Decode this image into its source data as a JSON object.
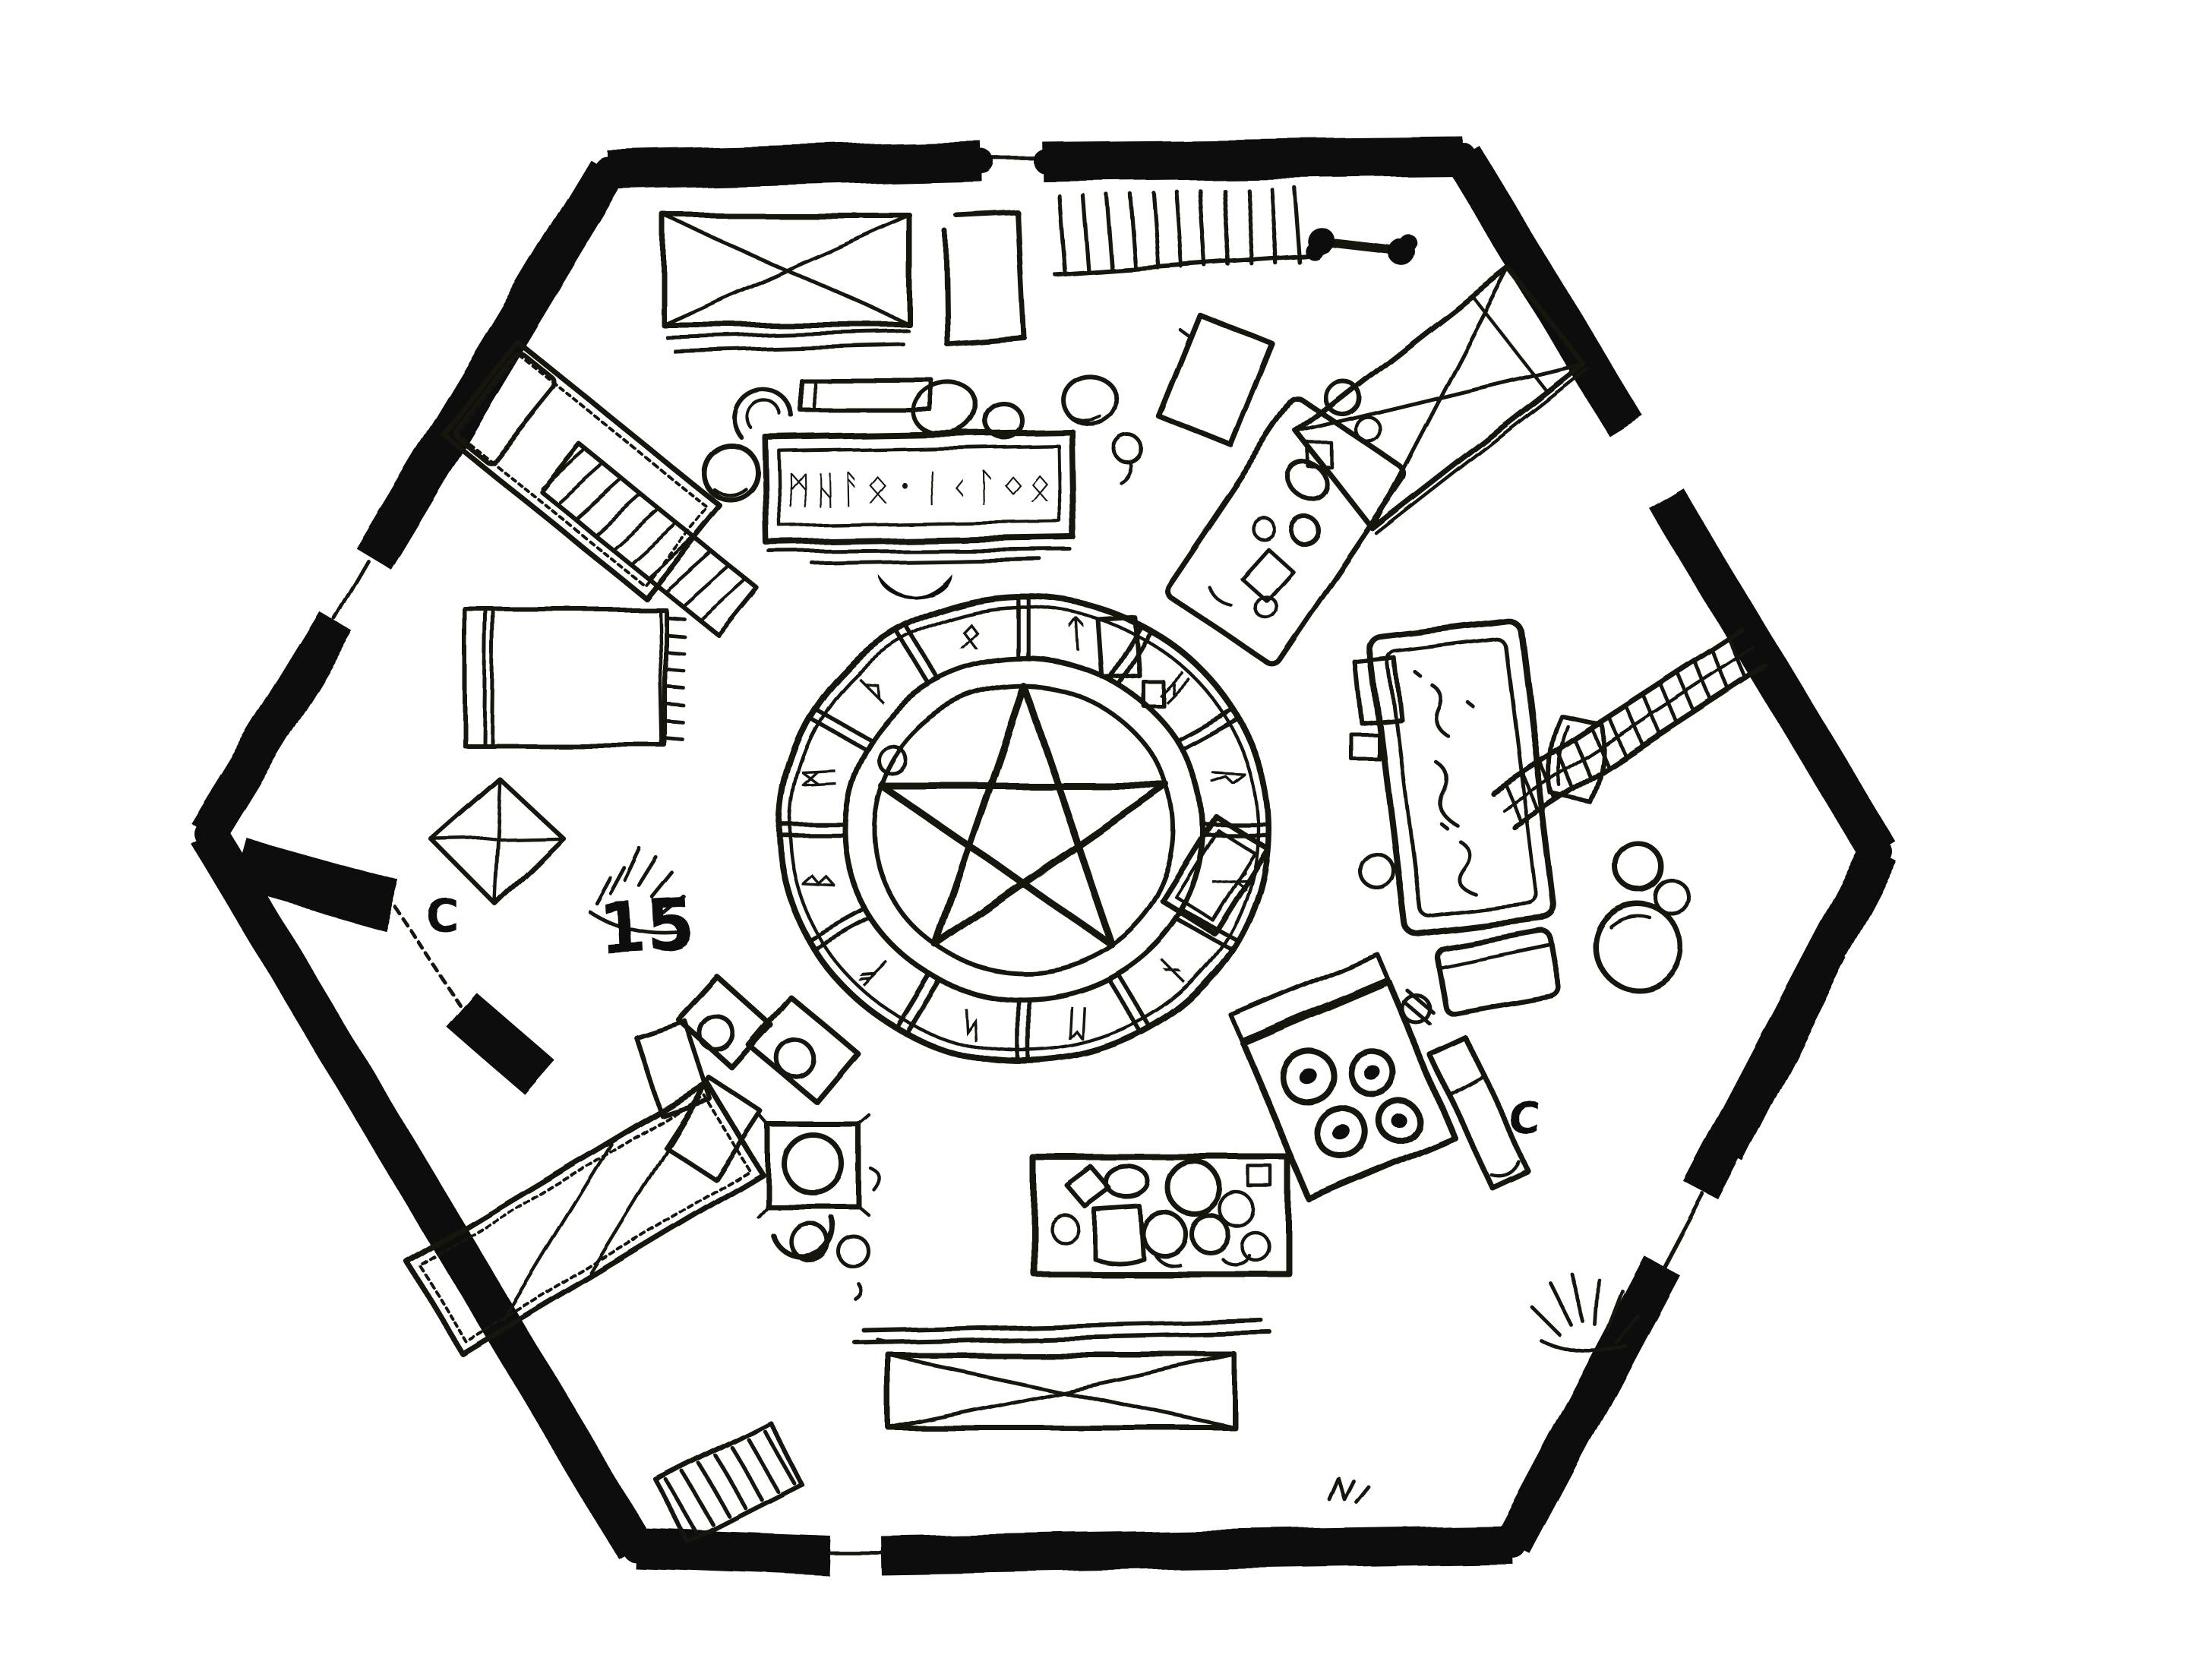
{
  "style": {
    "ink": "#161210",
    "wall": "#0b0908",
    "paper": "#ffffff"
  },
  "document": {
    "type": "hand-drawn dungeon floor plan",
    "room_shape": "hexagon",
    "drawing_medium": "black ink on white"
  },
  "labels": {
    "room_number": "15",
    "door_label_left": "C",
    "door_label_right": "C"
  },
  "inscription": {
    "desk_scrawl": "ᛗᚺᚨᛟ᛫ᛁᚲᛚᛜᛟ"
  },
  "magic_circle": {
    "kind": "summoning circle with pentagram",
    "segments": 12,
    "glyphs": [
      "ᛏ",
      "ᚺ",
      "ᚱ",
      "ᛉ",
      "ᚾ",
      "ᛖ",
      "ᛋ",
      "ᚠ",
      "ᛒ",
      "ᛗ",
      "ᚦ",
      "ᛟ"
    ]
  },
  "furniture_legend": [
    "crate-with-x-lid",
    "storage-box",
    "bench",
    "scribe-desk-with-inscription",
    "stool",
    "round-chair",
    "stone-cluster",
    "pebble-with-tail",
    "hatched-shelf",
    "bone-handle",
    "bed-with-pillow",
    "rolled-mattress",
    "tent-flap",
    "scratch-marks",
    "square-rug-with-fringe",
    "bed-with-x-cover",
    "side-table-with-vessels",
    "jars",
    "bathing-tub",
    "barrel",
    "ladder",
    "cauldrons",
    "stove-with-four-burners",
    "work-bench",
    "cluttered-work-table",
    "long-chest-with-x",
    "chairs-and-papers",
    "brazier-table",
    "hay-scratches",
    "floor-grill",
    "lectern",
    "summoning-circle",
    "pentagram"
  ]
}
